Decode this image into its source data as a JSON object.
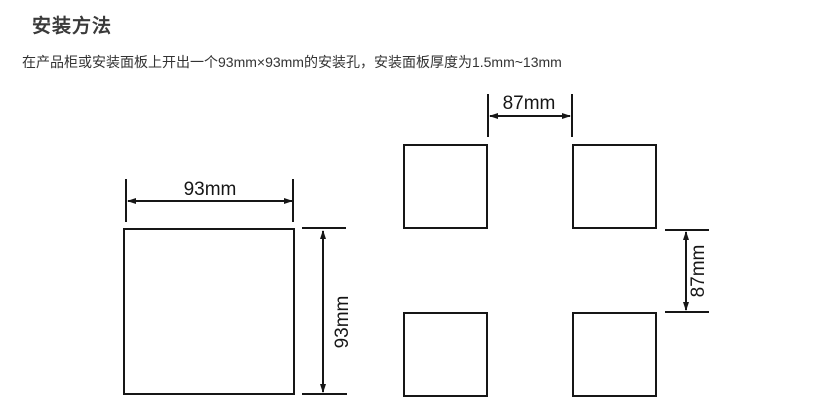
{
  "page": {
    "title": "安装方法",
    "body_text": "在产品柜或安装面板上开出一个93mm×93mm的安装孔，安装面板厚度为1.5mm~13mm"
  },
  "single_cutout_diagram": {
    "width_dim_label": "93mm",
    "height_dim_label": "93mm"
  },
  "grid_cutout_diagram": {
    "horizontal_gap_label": "87mm",
    "vertical_gap_label": "87mm"
  },
  "colors": {
    "line": "#161616",
    "heading_text": "#3a3a3a",
    "body_text": "#333333",
    "background": "#ffffff"
  }
}
